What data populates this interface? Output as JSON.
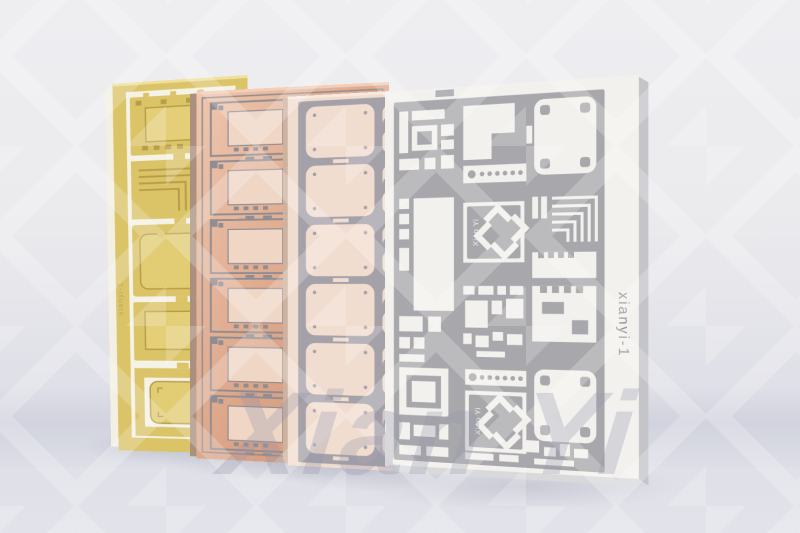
{
  "scene": {
    "description": "Product photo of four microwave PCB process panels (gold, copper, rose-gold, silver-white) standing upright against a gray studio background",
    "background": {
      "wall_color": "#ecebee",
      "floor_color": "#dddee6"
    },
    "watermark": {
      "text": "Xian Yi",
      "text_color": "#9496a8",
      "pattern_icon": "diamond-pinwheel",
      "pattern_color": "#ffffff"
    }
  },
  "boards": [
    {
      "id": "gold-panel",
      "finish": "gold",
      "face_color": "#dbc367",
      "substrate_color": "#f5f2e6",
      "trace_color": "#b89d48",
      "edge_color": "#f3efe2",
      "serial_label": "xianyi-1"
    },
    {
      "id": "copper-panel",
      "finish": "copper",
      "face_color": "#dca588",
      "pad_color": "#f0d6c5",
      "trace_color": "#8f8c92",
      "edge_color": "#ab9080"
    },
    {
      "id": "rose-gold-panel",
      "finish": "rose-gold",
      "face_color": "#f1ddcf",
      "mask_color": "#a4a1a9",
      "edge_color": "#cdb2a0"
    },
    {
      "id": "silver-panel",
      "finish": "silver-white",
      "face_color": "#f2f1ee",
      "mask_color": "#a8a8ac",
      "edge_color": "#c5c5c9",
      "serial_label": "xianyi-1",
      "serial_color": "#8d8d93",
      "logo_text": "Xian Yi",
      "logo_icon": "pinwheel"
    }
  ]
}
